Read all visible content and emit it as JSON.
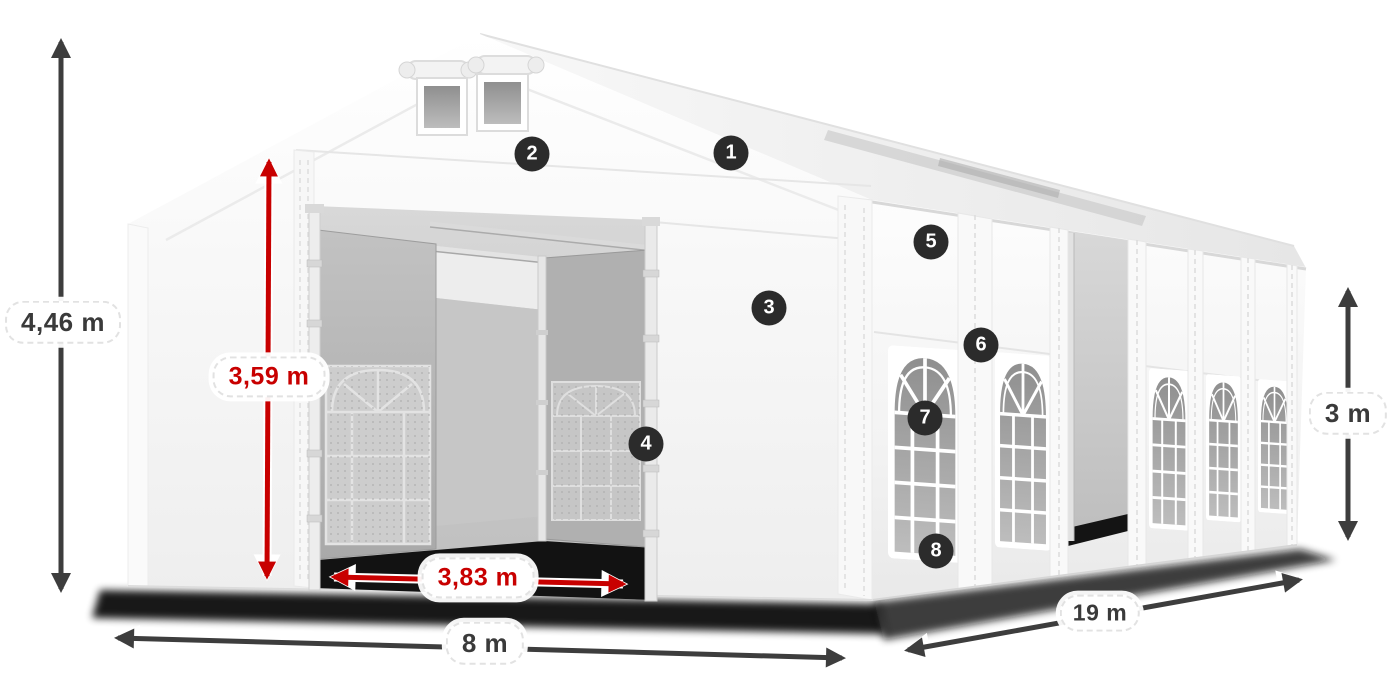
{
  "diagram": {
    "subject": "marquee-tent-dimension-diagram",
    "colors": {
      "canvas": "#ffffff",
      "dimension_dark": "#3d3d3d",
      "dimension_red": "#c80000",
      "badge_background": "#2b2b2b",
      "badge_text": "#ffffff"
    },
    "dimensions": {
      "total_height": "4,46 m",
      "entrance_height": "3,59 m",
      "entrance_width": "3,83 m",
      "front_width": "8 m",
      "side_length": "19 m",
      "wall_height": "3 m"
    },
    "callouts": {
      "c1": "1",
      "c2": "2",
      "c3": "3",
      "c4": "4",
      "c5": "5",
      "c6": "6",
      "c7": "7",
      "c8": "8"
    }
  }
}
